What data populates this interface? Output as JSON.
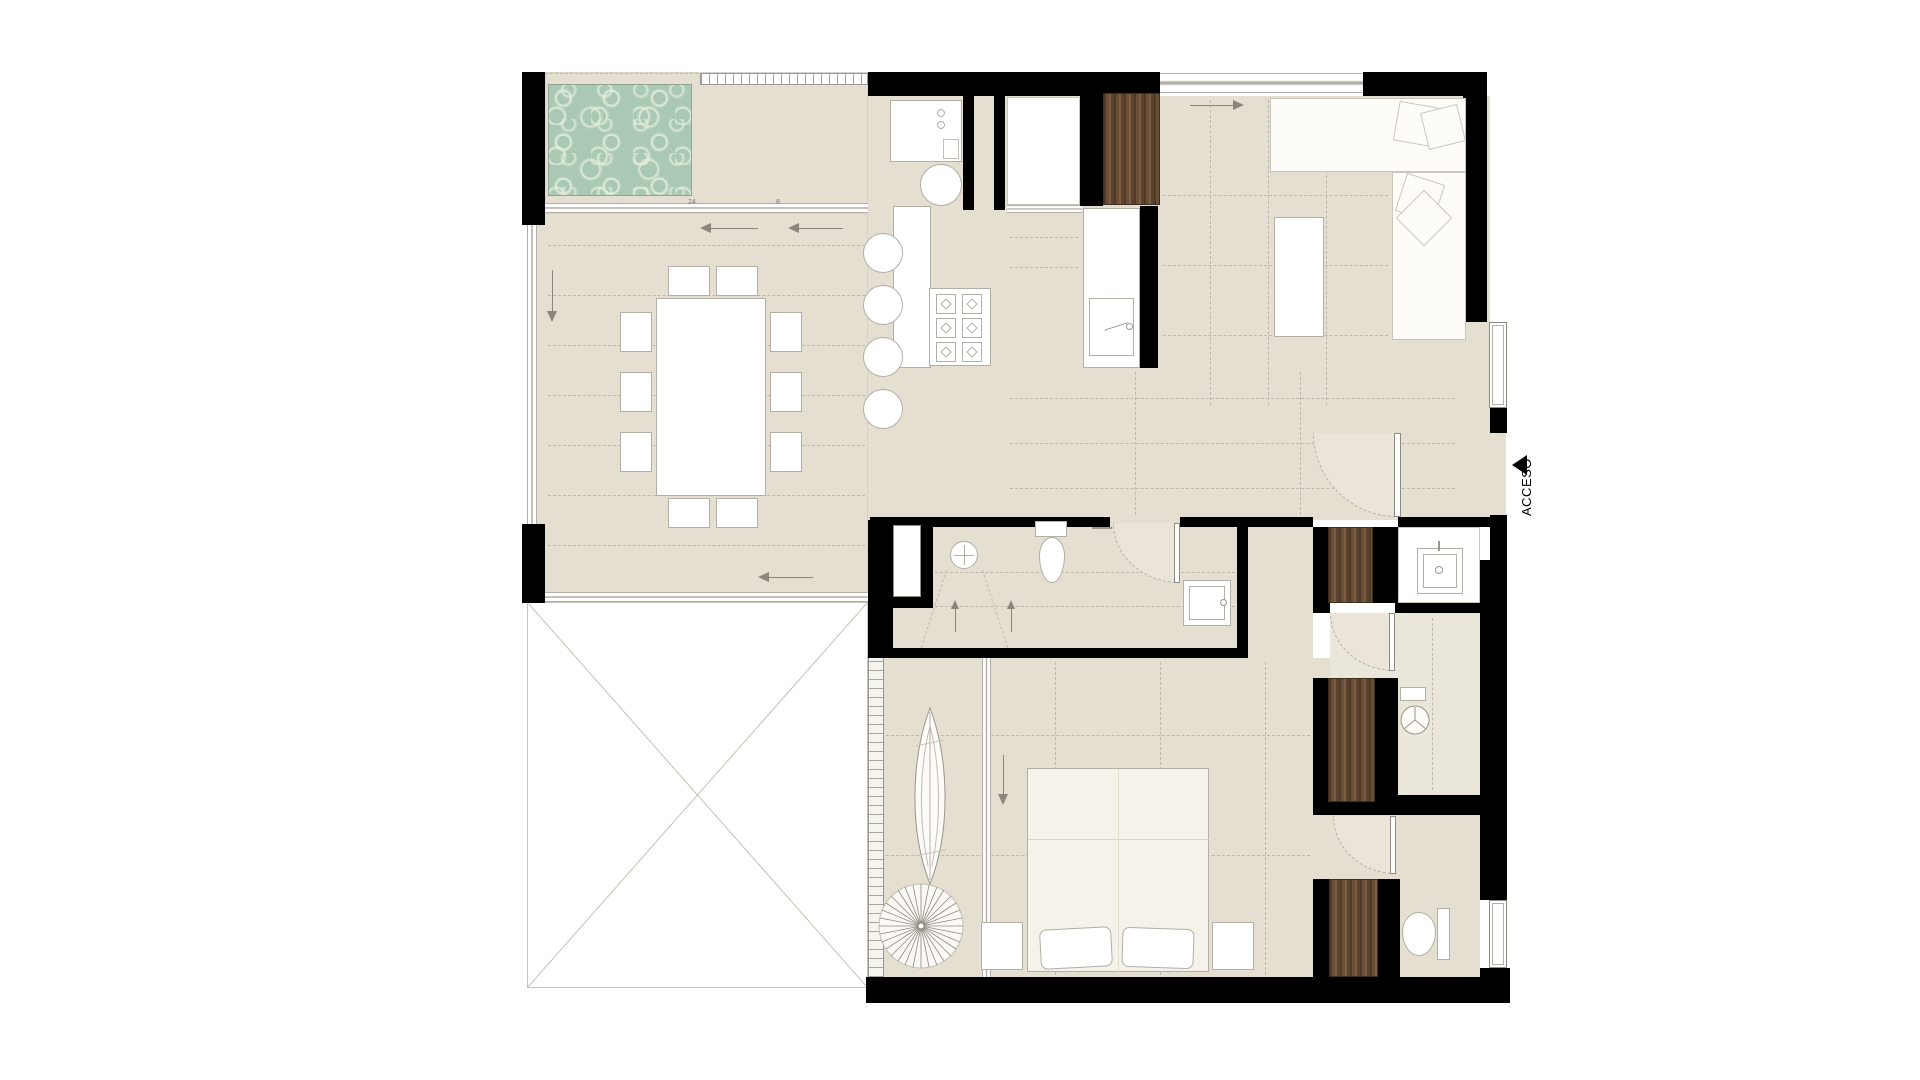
{
  "plan": {
    "type": "apartment-floor-plan",
    "access_label": "ACCESO",
    "dimension_marks": {
      "pool_track": "24",
      "kitchen_track": "8"
    }
  },
  "colors": {
    "wall": "#000000",
    "floor": "#e5dfd2",
    "floor_light": "#ebe6da",
    "swing": "#eae4d9",
    "pool_water": "#a9c9b5",
    "pool_light": "#e9f1de",
    "wood_dark": "#5a4430",
    "wood_light": "#85664a",
    "line": "#b3afa6",
    "line_light": "#cac6bc",
    "dash": "#bdb8ab",
    "arrow": "#8b867c"
  }
}
